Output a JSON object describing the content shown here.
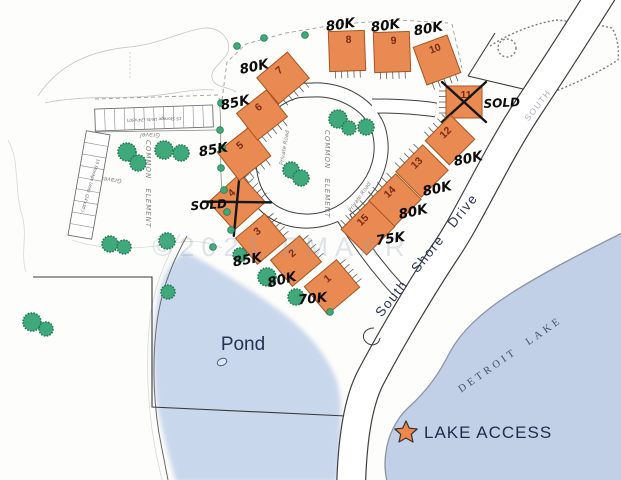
{
  "map": {
    "labels": {
      "pond": "Pond",
      "lake": "DETROIT LAKE",
      "lake_access": "LAKE ACCESS",
      "street": "South Shore Drive",
      "street_far": "SOUTH",
      "private_road": "Private Road",
      "common_element": "COMMON ELEMENT",
      "gravel": "Gravel",
      "storage_units": "15 Storage Units (24'x30')",
      "watermark": "©2021 FMAAR"
    },
    "colors": {
      "lot_fill": "#e98a53",
      "lot_stroke": "#a8551f",
      "lot_number": "#7a2b15",
      "pond_fill": "#c9d7ec",
      "lake_fill": "#c1d0e6",
      "water_edge": "#8b95a6",
      "tree_fill": "#3fa97c",
      "tree_stroke": "#1f7a52",
      "navy_text": "#22304e",
      "star_fill": "#f0874a",
      "ink": "#0c0c0c"
    },
    "lots": [
      {
        "number": "1",
        "price": "70K",
        "sold": false,
        "cx": 332,
        "cy": 287,
        "w": 42,
        "h": 36,
        "rot": -40,
        "hatch": "right",
        "px": 313,
        "py": 303,
        "prot": -6
      },
      {
        "number": "2",
        "price": "80K",
        "sold": false,
        "cx": 296,
        "cy": 261,
        "w": 38,
        "h": 34,
        "rot": -40,
        "hatch": "right",
        "px": 283,
        "py": 284,
        "prot": -14
      },
      {
        "number": "3",
        "price": "85K",
        "sold": false,
        "cx": 261,
        "cy": 239,
        "w": 38,
        "h": 34,
        "rot": -40,
        "hatch": "right",
        "px": 248,
        "py": 264,
        "prot": -10
      },
      {
        "number": "4",
        "price": "SOLD",
        "sold": true,
        "cx": 237,
        "cy": 202,
        "w": 42,
        "h": 38,
        "rot": -42,
        "hatch": "right",
        "px": 209,
        "py": 209,
        "prot": -4
      },
      {
        "number": "5",
        "price": "85K",
        "sold": false,
        "cx": 244,
        "cy": 154,
        "w": 40,
        "h": 36,
        "rot": -38,
        "hatch": "bottom",
        "px": 214,
        "py": 154,
        "prot": -10
      },
      {
        "number": "6",
        "price": "85K",
        "sold": false,
        "cx": 262,
        "cy": 115,
        "w": 38,
        "h": 34,
        "rot": -38,
        "hatch": "bottom",
        "px": 236,
        "py": 107,
        "prot": -12
      },
      {
        "number": "7",
        "price": "80K",
        "sold": false,
        "cx": 283,
        "cy": 78,
        "w": 40,
        "h": 34,
        "rot": -40,
        "hatch": "bottom",
        "px": 255,
        "py": 71,
        "prot": -12
      },
      {
        "number": "8",
        "price": "80K",
        "sold": false,
        "cx": 347,
        "cy": 51,
        "w": 36,
        "h": 40,
        "rot": -2,
        "hatch": "bottom",
        "px": 341,
        "py": 29,
        "prot": -8
      },
      {
        "number": "9",
        "price": "80K",
        "sold": false,
        "cx": 392,
        "cy": 52,
        "w": 36,
        "h": 40,
        "rot": -2,
        "hatch": "bottom",
        "px": 386,
        "py": 30,
        "prot": -8
      },
      {
        "number": "10",
        "price": "80K",
        "sold": false,
        "cx": 437,
        "cy": 60,
        "w": 36,
        "h": 40,
        "rot": -20,
        "hatch": "bottom",
        "px": 429,
        "py": 33,
        "prot": -10
      },
      {
        "number": "11",
        "price": "SOLD",
        "sold": true,
        "cx": 464,
        "cy": 102,
        "w": 36,
        "h": 32,
        "rot": 0,
        "hatch": "left",
        "px": 502,
        "py": 107,
        "prot": -3
      },
      {
        "number": "12",
        "price": "80K",
        "sold": false,
        "cx": 450,
        "cy": 140,
        "w": 36,
        "h": 34,
        "rot": -45,
        "hatch": "top",
        "px": 469,
        "py": 163,
        "prot": -12
      },
      {
        "number": "13",
        "price": "80K",
        "sold": false,
        "cx": 422,
        "cy": 171,
        "w": 38,
        "h": 36,
        "rot": -45,
        "hatch": "top",
        "px": 438,
        "py": 193,
        "prot": -12
      },
      {
        "number": "14",
        "price": "80K",
        "sold": false,
        "cx": 395,
        "cy": 200,
        "w": 38,
        "h": 36,
        "rot": -45,
        "hatch": "top",
        "px": 414,
        "py": 216,
        "prot": -12
      },
      {
        "number": "15",
        "price": "75K",
        "sold": false,
        "cx": 368,
        "cy": 228,
        "w": 40,
        "h": 36,
        "rot": -45,
        "hatch": "top",
        "px": 391,
        "py": 243,
        "prot": -8
      }
    ],
    "storage_buildings": [
      {
        "cx": 154,
        "cy": 118,
        "w": 118,
        "h": 22,
        "rot": -2,
        "stalls": 12,
        "text_rot": 180
      },
      {
        "cx": 89,
        "cy": 185,
        "w": 24,
        "h": 106,
        "rot": 10,
        "stalls": 9,
        "text_rot": 97
      }
    ],
    "trees": {
      "puffs": [
        [
          127,
          152,
          9
        ],
        [
          138,
          163,
          8
        ],
        [
          164,
          150,
          9
        ],
        [
          181,
          153,
          8
        ],
        [
          291,
          170,
          8
        ],
        [
          301,
          178,
          8
        ],
        [
          338,
          119,
          9
        ],
        [
          349,
          128,
          7
        ],
        [
          366,
          127,
          8
        ],
        [
          110,
          244,
          8
        ],
        [
          124,
          247,
          7
        ],
        [
          167,
          241,
          8
        ],
        [
          168,
          292,
          7
        ],
        [
          240,
          255,
          7
        ],
        [
          267,
          277,
          9
        ],
        [
          296,
          297,
          8
        ],
        [
          32,
          322,
          9
        ],
        [
          46,
          329,
          7
        ]
      ],
      "dots": [
        [
          237,
          46
        ],
        [
          264,
          38
        ],
        [
          305,
          35
        ],
        [
          221,
          103
        ],
        [
          220,
          130
        ],
        [
          222,
          148
        ],
        [
          221,
          168
        ],
        [
          224,
          190
        ],
        [
          227,
          212
        ],
        [
          231,
          230
        ],
        [
          213,
          247
        ],
        [
          330,
          312
        ]
      ]
    }
  }
}
